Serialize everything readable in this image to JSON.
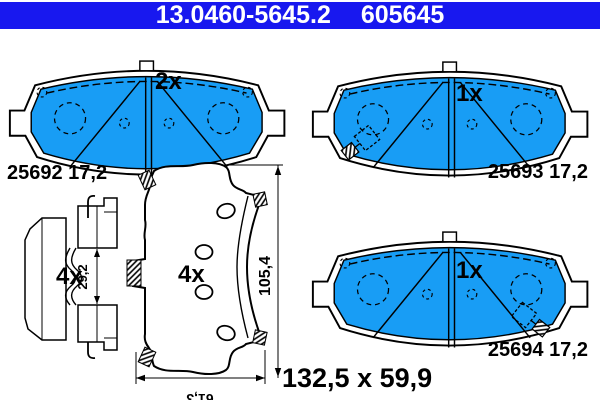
{
  "header": {
    "part_number": "13.0460-5645.2",
    "ref_number": "605645"
  },
  "colors": {
    "header_bg": "#1818ef",
    "pad_fill": "#189df5",
    "line": "#000000",
    "bg": "#ffffff"
  },
  "pads": {
    "top_left": {
      "quantity": "2x",
      "label": "25692 17,2"
    },
    "top_right": {
      "quantity": "1x",
      "label": "25693 17,2"
    },
    "bottom_right": {
      "quantity": "1x",
      "label": "25694 17,2"
    }
  },
  "back_view": {
    "quantity": "4x",
    "height_dim": "105,4",
    "width_dim": "61,3"
  },
  "accessory_clip": {
    "quantity": "4x",
    "gap_dim": "29,2"
  },
  "overall": {
    "dimensions_label": "132,5 x 59,9"
  }
}
